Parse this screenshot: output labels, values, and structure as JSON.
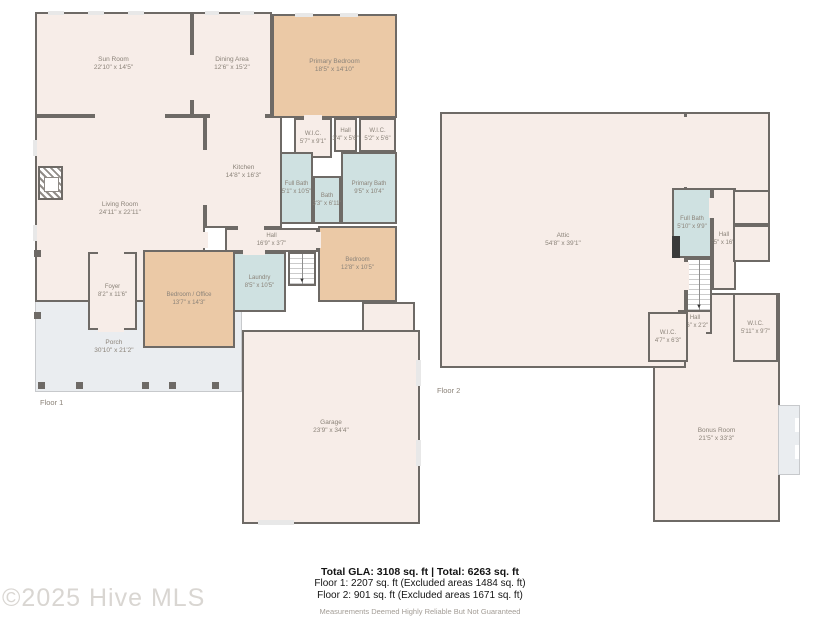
{
  "floor1": {
    "label": "Floor 1",
    "rooms": {
      "sun": {
        "name": "Sun Room",
        "dims": "22'10\" x 14'5\""
      },
      "dining": {
        "name": "Dining Area",
        "dims": "12'6\" x 15'2\""
      },
      "primary_bedroom": {
        "name": "Primary Bedroom",
        "dims": "18'5\" x 14'10\""
      },
      "wic_a": {
        "name": "W.I.C.",
        "dims": "5'7\" x 9'1\""
      },
      "hall_c": {
        "name": "Hall",
        "dims": "3'4\" x 5'6\""
      },
      "wic_b": {
        "name": "W.I.C.",
        "dims": "5'2\" x 5'6\""
      },
      "kitchen": {
        "name": "Kitchen",
        "dims": "14'8\" x 16'3\""
      },
      "full_bath": {
        "name": "Full Bath",
        "dims": "5'1\" x 10'5\""
      },
      "bath": {
        "name": "Bath",
        "dims": "3'3\" x 6'11\""
      },
      "primary_bath": {
        "name": "Primary Bath",
        "dims": "9'5\" x 10'4\""
      },
      "living": {
        "name": "Living Room",
        "dims": "24'11\" x 22'11\""
      },
      "hall": {
        "name": "Hall",
        "dims": "16'9\" x 3'7\""
      },
      "laundry": {
        "name": "Laundry",
        "dims": "8'5\" x 10'5\""
      },
      "bedroom": {
        "name": "Bedroom",
        "dims": "12'8\" x 10'5\""
      },
      "foyer": {
        "name": "Foyer",
        "dims": "8'2\" x 11'6\""
      },
      "bedroom_office": {
        "name": "Bedroom / Office",
        "dims": "13'7\" x 14'3\""
      },
      "porch": {
        "name": "Porch",
        "dims": "30'10\" x 21'2\""
      },
      "garage": {
        "name": "Garage",
        "dims": "23'9\" x 34'4\""
      }
    }
  },
  "floor2": {
    "label": "Floor 2",
    "rooms": {
      "attic": {
        "name": "Attic",
        "dims": "54'8\" x 39'1\""
      },
      "full_bath": {
        "name": "Full Bath",
        "dims": "5'10\" x 9'9\""
      },
      "hall_upper": {
        "name": "Hall",
        "dims": "3'5\" x 16'2\""
      },
      "hall_lower": {
        "name": "Hall",
        "dims": "3'6\" x 2'2\""
      },
      "wic_left": {
        "name": "W.I.C.",
        "dims": "4'7\" x 6'3\""
      },
      "wic_right": {
        "name": "W.I.C.",
        "dims": "5'11\" x 9'7\""
      },
      "bonus": {
        "name": "Bonus Room",
        "dims": "21'5\" x 33'3\""
      }
    }
  },
  "summary": {
    "total_line": "Total GLA: 3108 sq. ft | Total: 6263 sq. ft",
    "floor1_line": "Floor 1: 2207 sq. ft (Excluded areas 1484 sq. ft)",
    "floor2_line": "Floor 2: 901 sq. ft (Excluded areas 1671 sq. ft)",
    "disclaimer": "Measurements Deemed Highly Reliable But Not Guaranteed"
  },
  "watermark": "©2025 Hive MLS",
  "colors": {
    "wall": "#6e6a66",
    "room_fill": "#f7ede8",
    "bedroom_fill": "#ebc9a6",
    "bath_fill": "#cfe1e1",
    "porch_fill": "#eaedf0"
  }
}
